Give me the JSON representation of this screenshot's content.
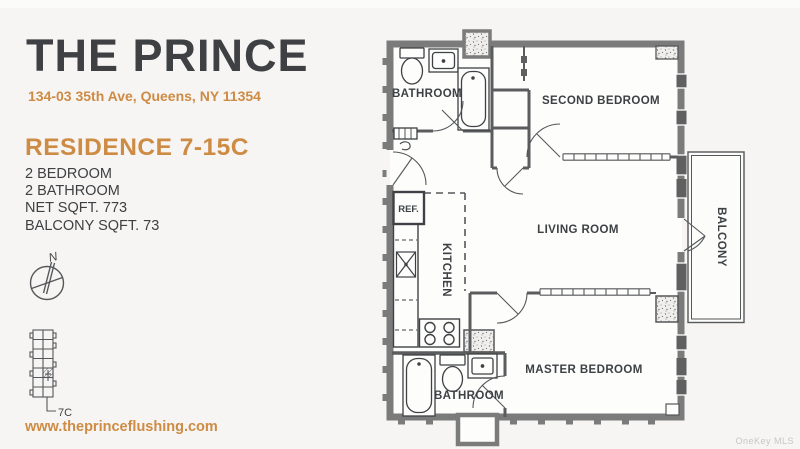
{
  "page": {
    "background": "#f6f5f3",
    "accent_color": "#cd8b44",
    "ink_color": "#3e4043",
    "wall_color": "#7b7b7b"
  },
  "left_panel": {
    "title": "THE PRINCE",
    "address": "134-03 35th Ave, Queens, NY 11354",
    "residence": "RESIDENCE 7-15C",
    "details": [
      "2 BEDROOM",
      "2 BATHROOM",
      "NET SQFT. 773",
      "BALCONY SQFT. 73"
    ],
    "compass_label": "N",
    "unit_marker": "7C",
    "website": "www.theprinceflushing.com"
  },
  "floor_plan": {
    "rooms": {
      "bathroom_top": "BATHROOM",
      "second_bedroom": "SECOND BEDROOM",
      "living_room": "LIVING ROOM",
      "kitchen": "KITCHEN",
      "ref": "REF.",
      "master_bedroom": "MASTER BEDROOM",
      "bathroom_bottom": "BATHROOM",
      "balcony": "BALCONY"
    }
  },
  "watermark": "OneKey MLS"
}
